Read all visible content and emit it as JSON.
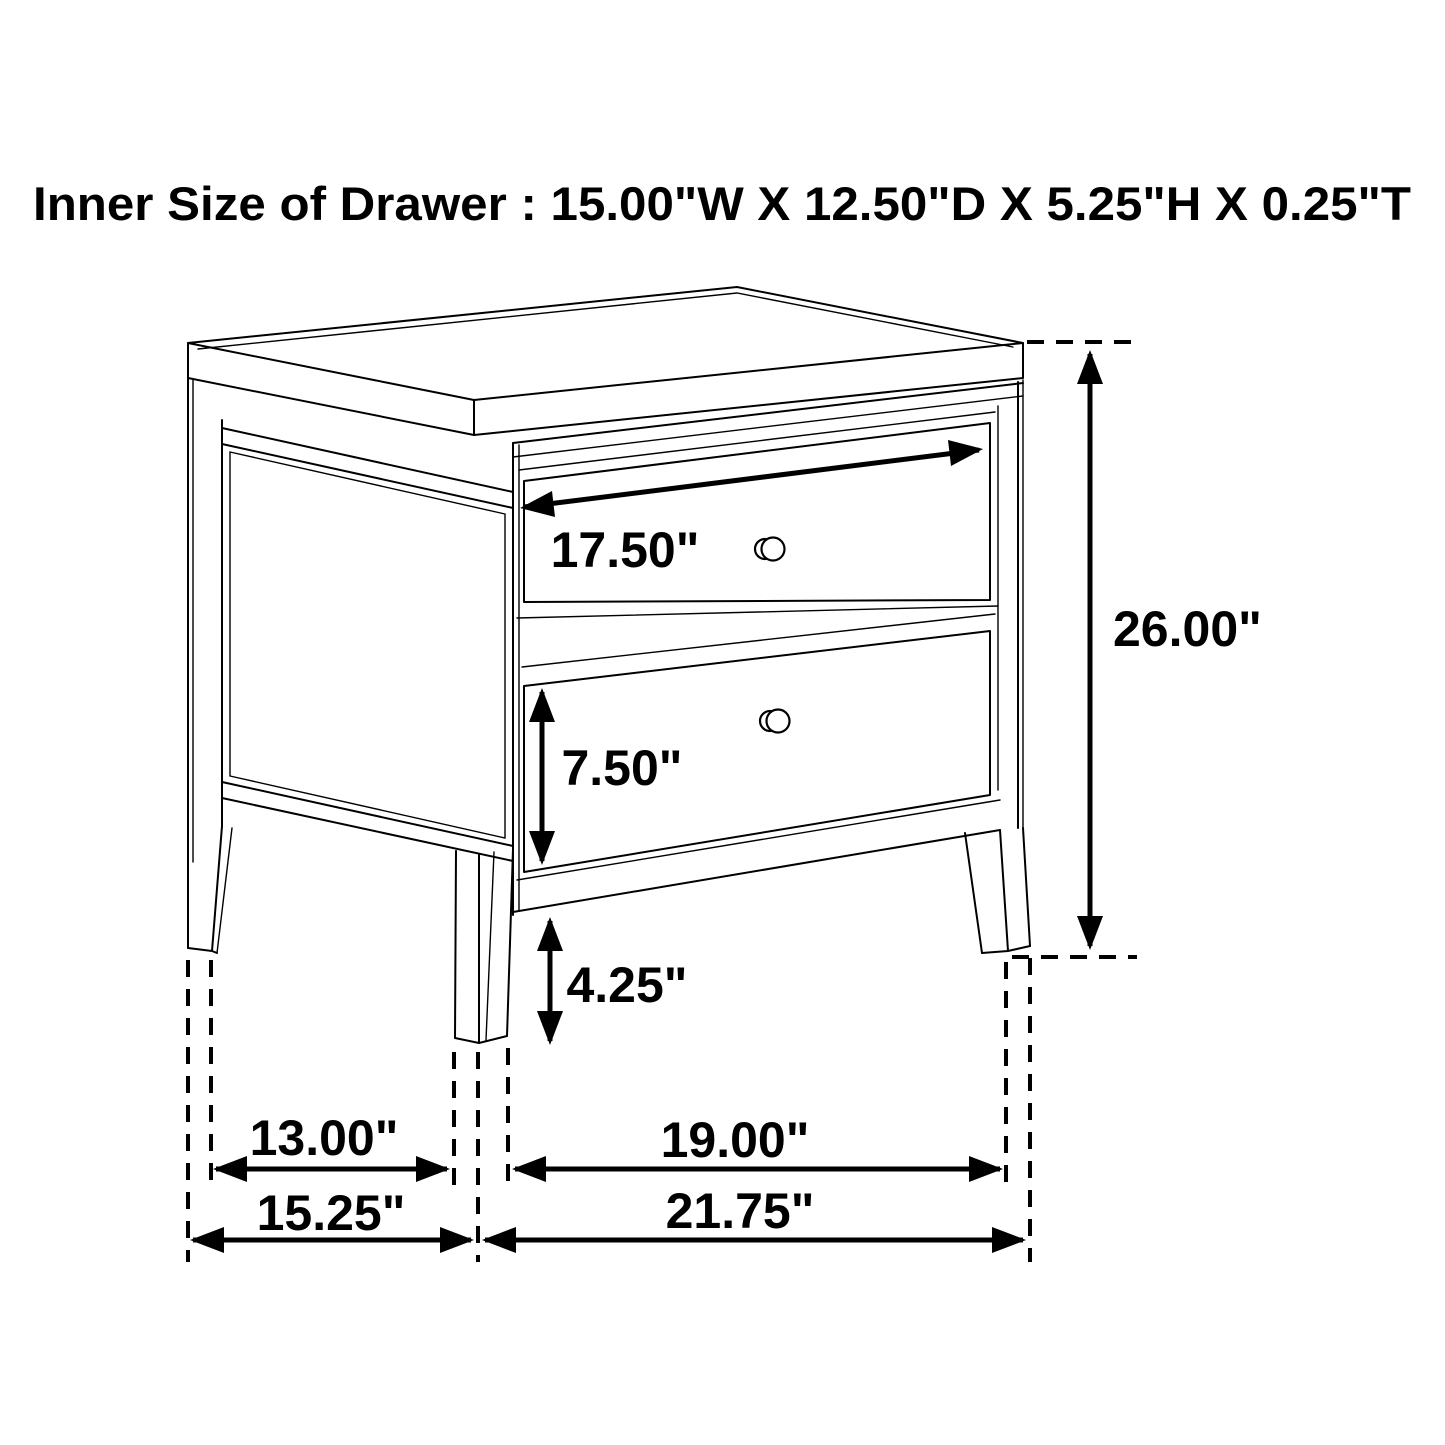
{
  "title": "Inner Size of Drawer : 15.00\"W X 12.50\"D X 5.25\"H X 0.25\"T",
  "figure": "two-drawer-nightstand-dimension-diagram",
  "dimensions": {
    "drawer_front_width": "17.50\"",
    "lower_drawer_height": "7.50\"",
    "leg_clearance": "4.25\"",
    "overall_height": "26.00\"",
    "side_leg_span": "13.00\"",
    "overall_depth": "15.25\"",
    "front_leg_span": "19.00\"",
    "overall_width": "21.75\""
  },
  "colors": {
    "line": "#000000",
    "background": "#ffffff"
  }
}
